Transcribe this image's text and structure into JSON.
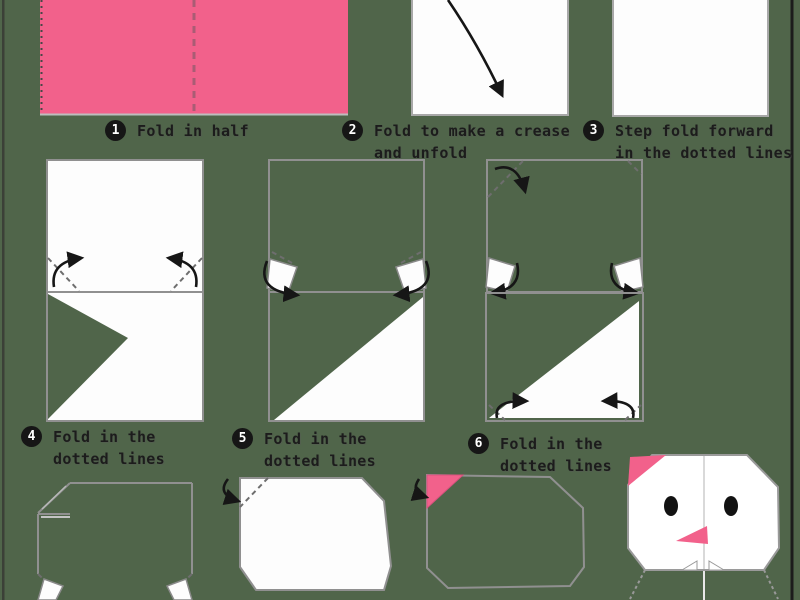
{
  "colors": {
    "background": "#50654a",
    "paper_white": "#fdfdfd",
    "paper_pink": "#f2618b",
    "outline_gray": "#909090",
    "fold_dash_gray": "#6e6e6e",
    "crease_on_pink": "#aa5c74",
    "arrow_black": "#161616",
    "eye_black": "#121212",
    "face_crease_gray": "#d9d9d9",
    "left_border": "#3b4037",
    "right_border": "#1c1c1c"
  },
  "steps": [
    {
      "num": "1",
      "label": "Fold in half",
      "label2": ""
    },
    {
      "num": "2",
      "label": "Fold to make a crease",
      "label2": "and unfold"
    },
    {
      "num": "3",
      "label": "Step fold forward",
      "label2": "in the dotted lines"
    },
    {
      "num": "4",
      "label": "Fold in the",
      "label2": "dotted lines"
    },
    {
      "num": "5",
      "label": "Fold in the",
      "label2": "dotted lines"
    },
    {
      "num": "6",
      "label": "Fold in the",
      "label2": "dotted lines"
    }
  ]
}
